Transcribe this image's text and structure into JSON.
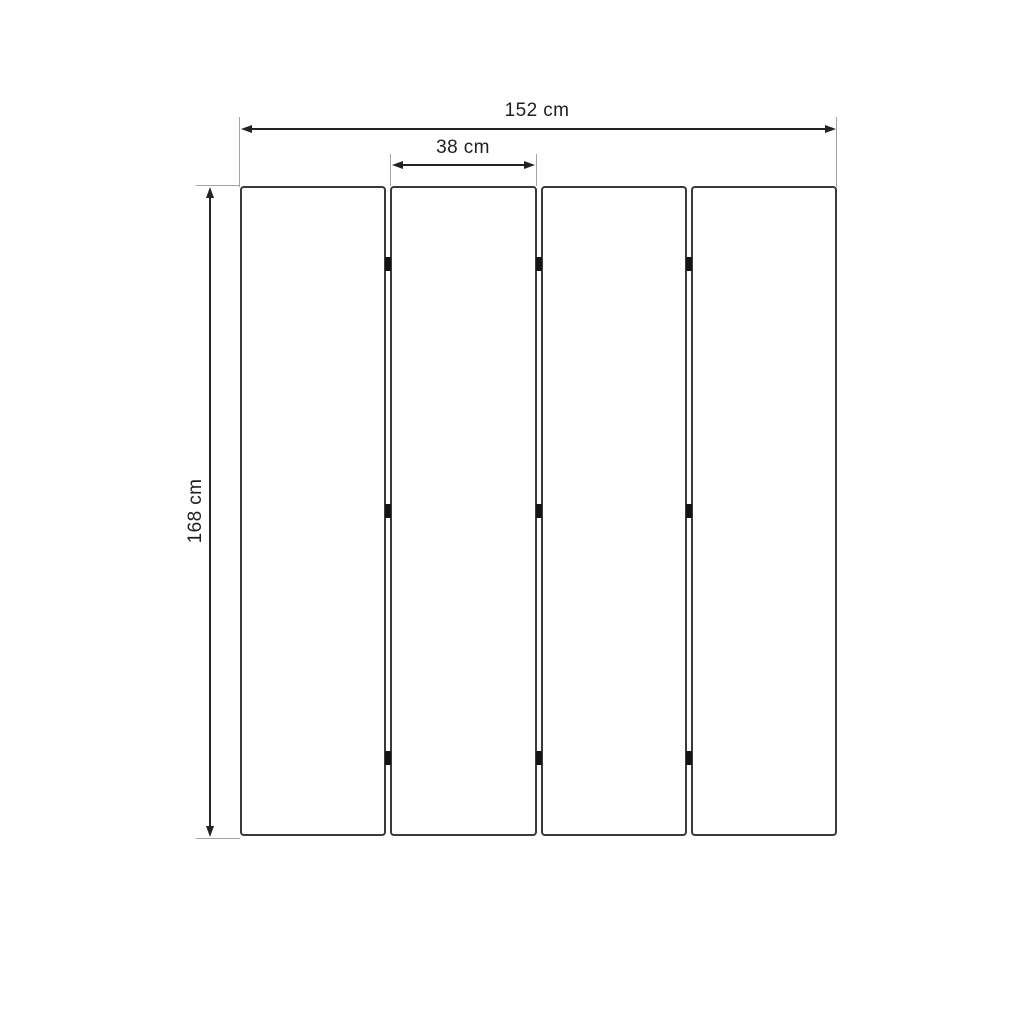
{
  "diagram": {
    "type": "dimension-drawing",
    "subject": "four-panel folding screen, front view with hinges",
    "panels": {
      "count": 4,
      "hinge_rows_per_gap": 3,
      "hinge_row_fractions": [
        0.12,
        0.5,
        0.88
      ]
    },
    "dimensions": {
      "total_width": {
        "label": "152 cm",
        "value": 152,
        "unit": "cm"
      },
      "panel_width": {
        "label": "38 cm",
        "value": 38,
        "unit": "cm"
      },
      "height": {
        "label": "168 cm",
        "value": 168,
        "unit": "cm"
      }
    },
    "colors": {
      "background": "#ffffff",
      "panel_border": "#3a3a3a",
      "dimension_line": "#232323",
      "extension_line": "#a2a2a2",
      "hinge": "#141414",
      "text": "#1f1f1f"
    }
  }
}
